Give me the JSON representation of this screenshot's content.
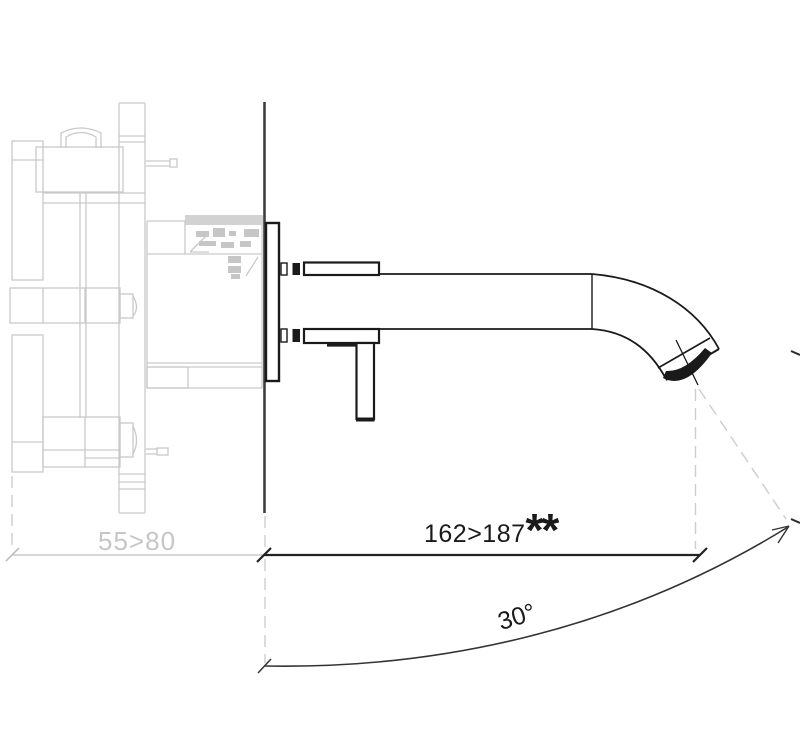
{
  "colors": {
    "line_black": "#1a1a1a",
    "wall_line_gray": "#3e3e3e",
    "ghost_gray": "#c9c9c9",
    "dim_text_gray": "#c6c6c6",
    "background": "#ffffff"
  },
  "dimensions": {
    "spout_projection": {
      "value": "162>187",
      "suffix": "**"
    },
    "rough_in_depth": {
      "value": "55>80"
    },
    "swivel_angle": {
      "value": "30°"
    }
  }
}
